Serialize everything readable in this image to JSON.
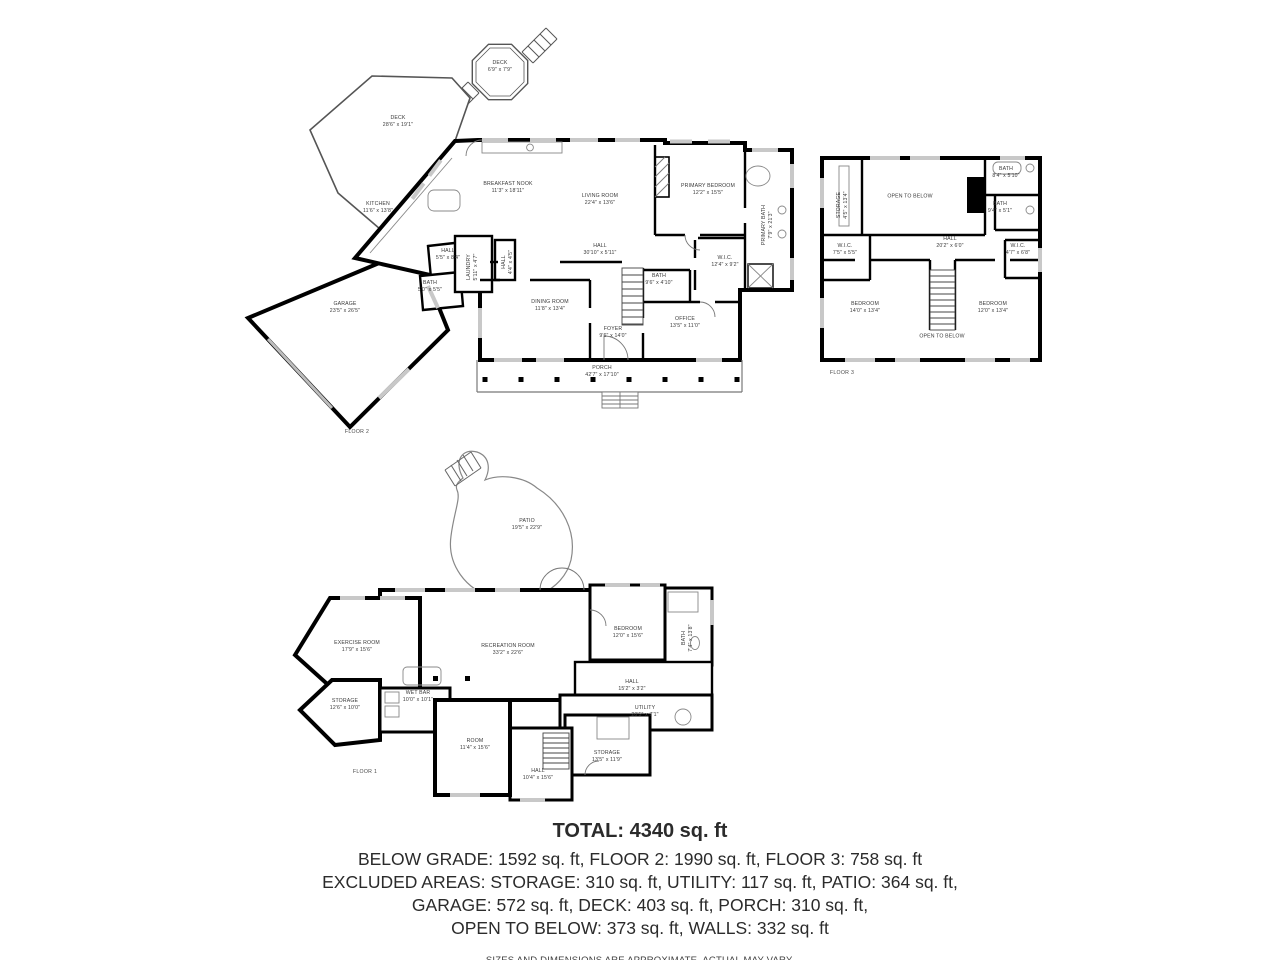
{
  "floors": [
    {
      "id": "floor2",
      "label": "FLOOR 2",
      "rooms": [
        {
          "name": "DECK",
          "dims": "6'9\" x 7'9\""
        },
        {
          "name": "DECK",
          "dims": "28'6\" x 19'1\""
        },
        {
          "name": "KITCHEN",
          "dims": "11'6\" x 13'8\""
        },
        {
          "name": "BREAKFAST NOOK",
          "dims": "11'3\" x 18'11\""
        },
        {
          "name": "LIVING ROOM",
          "dims": "22'4\" x 13'6\""
        },
        {
          "name": "PRIMARY BEDROOM",
          "dims": "12'2\" x 15'5\""
        },
        {
          "name": "PRIMARY BATH",
          "dims": "7'9\" x 21'3\""
        },
        {
          "name": "HALL",
          "dims": "30'10\" x 5'11\""
        },
        {
          "name": "W.I.C.",
          "dims": "12'4\" x 9'2\""
        },
        {
          "name": "BATH",
          "dims": "9'6\" x 4'10\""
        },
        {
          "name": "HALL",
          "dims": "5'5\" x 8'4\""
        },
        {
          "name": "BATH",
          "dims": "5'0\" x 5'5\""
        },
        {
          "name": "LAUNDRY",
          "dims": "5'11\" x 4'7\""
        },
        {
          "name": "HALL",
          "dims": "4'4\" x 4'5\""
        },
        {
          "name": "DINING ROOM",
          "dims": "11'8\" x 13'4\""
        },
        {
          "name": "FOYER",
          "dims": "9'6\" x 14'0\""
        },
        {
          "name": "OFFICE",
          "dims": "13'5\" x 11'0\""
        },
        {
          "name": "GARAGE",
          "dims": "23'5\" x 26'5\""
        },
        {
          "name": "PORCH",
          "dims": "42'7\" x 17'10\""
        }
      ]
    },
    {
      "id": "floor3",
      "label": "FLOOR 3",
      "rooms": [
        {
          "name": "STORAGE",
          "dims": "4'5\" x 13'4\""
        },
        {
          "name": "OPEN TO BELOW",
          "dims": ""
        },
        {
          "name": "BATH",
          "dims": "8'4\" x 5'10\""
        },
        {
          "name": "BATH",
          "dims": "9'4\" x 5'1\""
        },
        {
          "name": "HALL",
          "dims": "20'2\" x 6'0\""
        },
        {
          "name": "W.I.C.",
          "dims": "7'5\" x 5'5\""
        },
        {
          "name": "W.I.C.",
          "dims": "4'7\" x 6'8\""
        },
        {
          "name": "BEDROOM",
          "dims": "14'0\" x 13'4\""
        },
        {
          "name": "BEDROOM",
          "dims": "12'0\" x 13'4\""
        },
        {
          "name": "OPEN TO BELOW",
          "dims": ""
        }
      ]
    },
    {
      "id": "floor1",
      "label": "FLOOR 1",
      "rooms": [
        {
          "name": "PATIO",
          "dims": "19'5\" x 22'9\""
        },
        {
          "name": "EXERCISE ROOM",
          "dims": "17'9\" x 15'6\""
        },
        {
          "name": "RECREATION ROOM",
          "dims": "33'2\" x 22'6\""
        },
        {
          "name": "WET BAR",
          "dims": "10'0\" x 10'1\""
        },
        {
          "name": "STORAGE",
          "dims": "12'6\" x 10'0\""
        },
        {
          "name": "BEDROOM",
          "dims": "12'0\" x 15'6\""
        },
        {
          "name": "BATH",
          "dims": "7'4\" x 13'8\""
        },
        {
          "name": "HALL",
          "dims": "15'2\" x 3'2\""
        },
        {
          "name": "UTILITY",
          "dims": "20'5\" x 7'1\""
        },
        {
          "name": "ROOM",
          "dims": "11'4\" x 15'6\""
        },
        {
          "name": "HALL",
          "dims": "10'4\" x 15'6\""
        },
        {
          "name": "STORAGE",
          "dims": "13'5\" x 11'9\""
        }
      ]
    }
  ],
  "summary": {
    "total": "TOTAL: 4340 sq. ft",
    "line1": "BELOW GRADE: 1592 sq. ft, FLOOR 2: 1990 sq. ft, FLOOR 3: 758 sq. ft",
    "line2": "EXCLUDED AREAS: STORAGE: 310 sq. ft, UTILITY: 117 sq. ft, PATIO: 364 sq. ft,",
    "line3": "GARAGE: 572 sq. ft, DECK: 403 sq. ft, PORCH: 310 sq. ft,",
    "line4": "OPEN TO BELOW: 373 sq. ft, WALLS: 332 sq. ft",
    "disclaimer": "SIZES AND DIMENSIONS ARE APPROXIMATE, ACTUAL MAY VARY."
  },
  "colors": {
    "wall": "#000000",
    "thin_line": "#666666",
    "window": "#c8c8c8",
    "text": "#3a3a3a"
  }
}
